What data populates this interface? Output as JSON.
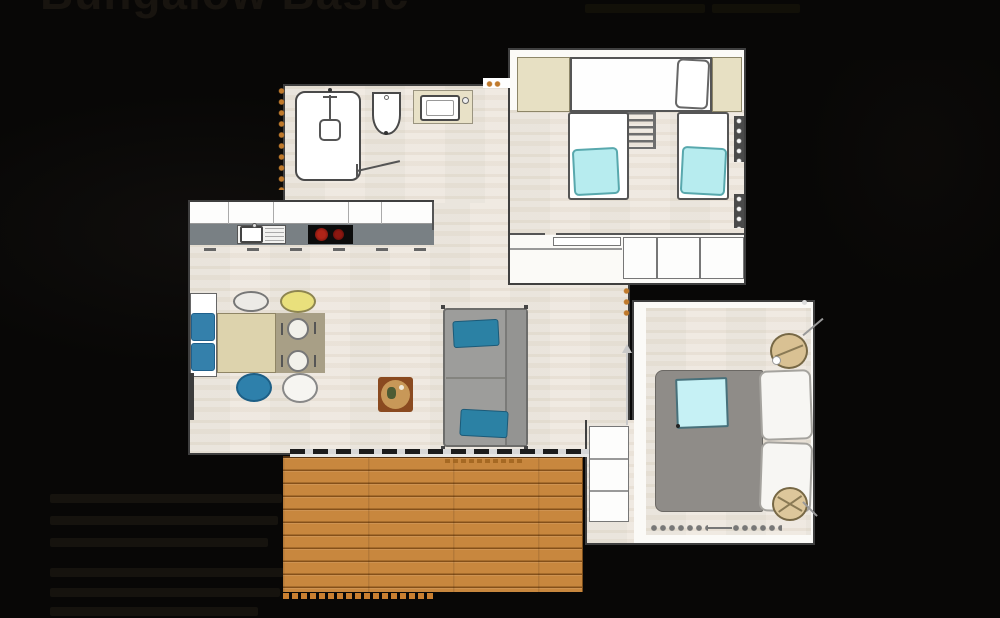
{
  "header": {
    "title": "Bungalow Basic"
  },
  "floorplan": {
    "description": "2D bungalow floor plan",
    "colors": {
      "background": "#080706",
      "floor_wood": "#efe9e0",
      "wall": "#3f3f3f",
      "kitchen_counter": "#798084",
      "deck_wood": "#c8873e",
      "pillow_cyan": "#b7ecef",
      "cushion_blue": "#3480ab",
      "sofa_gray": "#9d9d9b",
      "sofa_pillow_teal": "#2b81a4",
      "chair_yellow": "#e9e07c",
      "wardrobe_beige": "#e7e0c3",
      "bed_blanket_gray": "#8f8c88",
      "stool_tan": "#d9c193",
      "dimension_marker_orange": "#c07a2c"
    }
  }
}
